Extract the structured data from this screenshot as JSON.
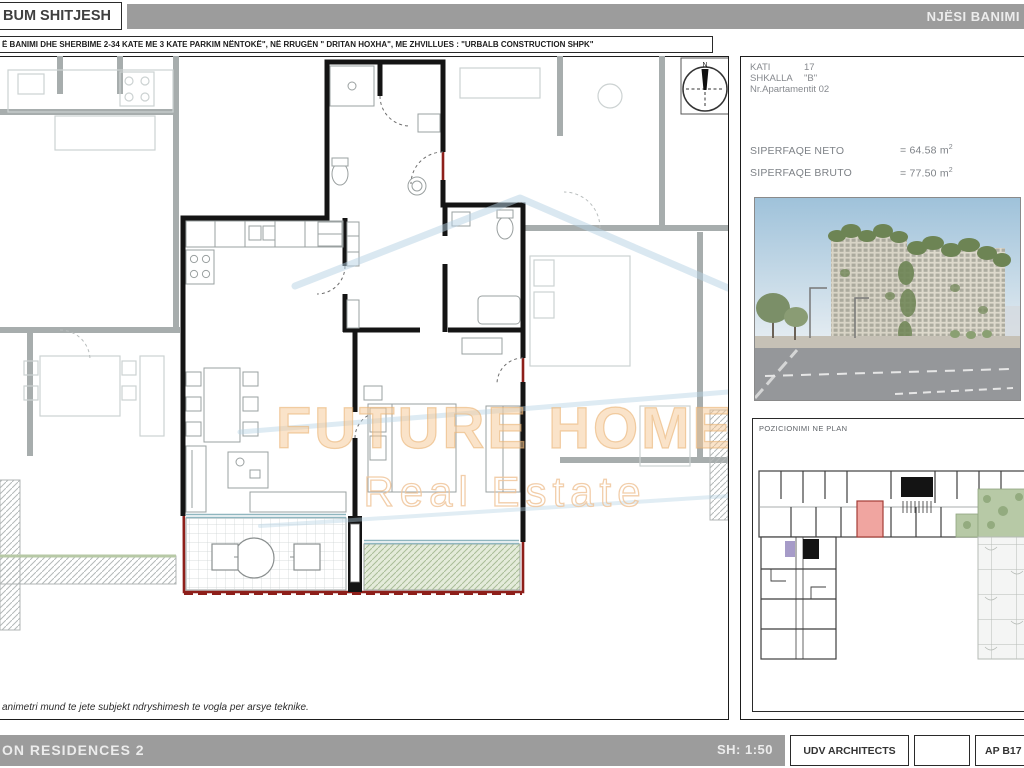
{
  "header": {
    "album_title": "BUM SHITJESH",
    "units_bar": "NJËSI BANIMI",
    "project_line": "Ë BANIMI DHE SHERBIME 2-34 KATE  ME 3 KATE PARKIM NËNTOKË\", NË RRUGËN \" DRITAN HOXHA\", ME  ZHVILLUES : \"URBALB CONSTRUCTION SHPK\""
  },
  "info": {
    "kati_label": "KATI",
    "kati_value": "17",
    "shkalla_label": "SHKALLA",
    "shkalla_value": "\"B\"",
    "apt_label": "Nr.Apartamentit",
    "apt_value": "02"
  },
  "areas": {
    "neto_label": "SIPERFAQE NETO",
    "neto_value": "= 64.58 m",
    "bruto_label": "SIPERFAQE BRUTO",
    "bruto_value": "= 77.50 m",
    "sup": "2"
  },
  "position_panel": {
    "title": "POZICIONIMI NE PLAN"
  },
  "compass": {
    "n": "N"
  },
  "watermark": {
    "line1": "FUTURE HOME",
    "line2": "Real Estate"
  },
  "disclaimer": {
    "text": "animetri mund te jete subjekt ndryshimesh te vogla per arsye teknike."
  },
  "footer": {
    "project": "ON RESIDENCES 2",
    "scale": "SH: 1:50",
    "architect": "UDV ARCHITECTS",
    "apartment_code": "AP B17"
  },
  "colors": {
    "accent_red": "#8e1f1a",
    "highlight_pink": "#f0a5a0",
    "bar_gray": "#9c9c9c",
    "watermark_orange": "#f3c08a",
    "watermark_blue": "#b5d2e4",
    "balcony_green": "#e4ebda"
  }
}
